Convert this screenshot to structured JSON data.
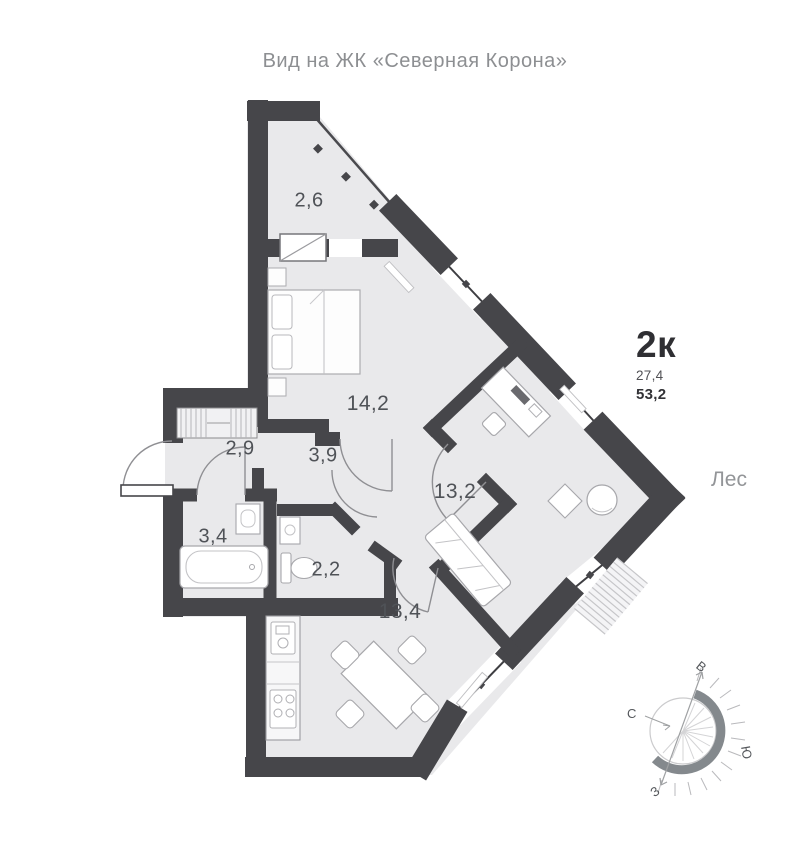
{
  "title": "Вид на ЖК «Северная Корона»",
  "unit": {
    "type": "2к",
    "areas": [
      "27,4",
      "53,2"
    ]
  },
  "environment_label": "Лес",
  "rooms": [
    {
      "id": "balcony",
      "area": "2,6"
    },
    {
      "id": "bedroom",
      "area": "14,2"
    },
    {
      "id": "corridor",
      "area": "2,9"
    },
    {
      "id": "hallway",
      "area": "3,9"
    },
    {
      "id": "living-room",
      "area": "13,2"
    },
    {
      "id": "bathroom",
      "area": "3,4"
    },
    {
      "id": "wc",
      "area": "2,2"
    },
    {
      "id": "kitchen-living",
      "area": "13,4"
    }
  ],
  "compass": {
    "north": "С",
    "east": "В",
    "south": "Ю",
    "west": "З"
  },
  "colors": {
    "wall": "#46464a",
    "room_fill": "#e9e9eb",
    "accent_text": "#2f2f33",
    "muted_text": "#8d8f92"
  }
}
